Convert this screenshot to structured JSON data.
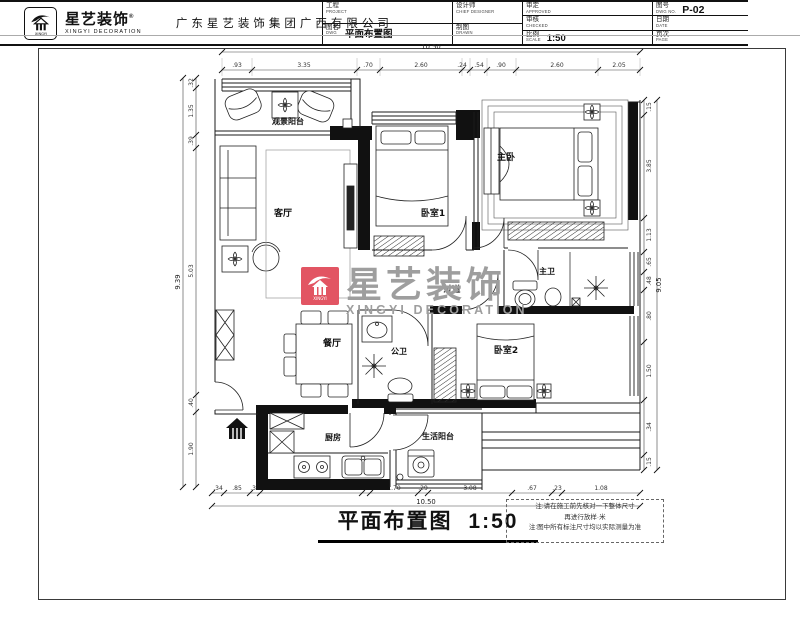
{
  "plan": {
    "rooms": {
      "balcony_view": "观景阳台",
      "living": "客厅",
      "bed1": "卧室1",
      "master": "主卧",
      "master_bath": "主卫",
      "dining": "餐厅",
      "guest_bath": "公卫",
      "corridor": "过道",
      "bed2": "卧室2",
      "kitchen": "厨房",
      "utility_balcony": "生活阳台"
    },
    "title": {
      "text": "平面布置图",
      "scale": "1:50"
    },
    "watermark": {
      "cn": "星艺装饰",
      "en": "XINGYI DECORATION"
    },
    "notes": {
      "line1": "注:请在施工前先核对一下整体尺寸",
      "line2": "再进行放样·米",
      "line3": "注:图中所有标注尺寸均以实际测量为准"
    }
  },
  "dims": {
    "top": {
      "total": "10.50",
      "segments": [
        ".93",
        "3.35",
        ".70",
        "2.60",
        ".24",
        ".54",
        ".90",
        "2.60",
        "2.05"
      ]
    },
    "bottom": {
      "total": "10.50",
      "segments": [
        ".34",
        ".85",
        ".34",
        "3.65",
        ".24",
        "1.70",
        ".29",
        "3.08",
        ".67",
        ".23",
        "1.08"
      ]
    },
    "left": {
      "total": "9.39",
      "segments": [
        ".32",
        "1.35",
        ".39",
        "5.03",
        ".40",
        "1.90"
      ]
    },
    "right": {
      "total": "9.05",
      "segments": [
        ".15",
        "3.85",
        "1.13",
        ".65",
        ".48",
        ".80",
        "1.50",
        ".34",
        ".15"
      ]
    }
  },
  "titleblock": {
    "logo": {
      "cn": "星艺装饰",
      "reg": "®",
      "en": "XINGYI DECORATION",
      "mark": "XINGYI"
    },
    "company": "广东星艺装饰集团广西有限公司",
    "fields": {
      "project": {
        "cn": "工程",
        "en": "PROJECT",
        "value": ""
      },
      "dwg": {
        "cn": "图名",
        "en": "DWG",
        "value": "平面布置图"
      },
      "designer": {
        "cn": "设计师",
        "en": "CHIEF DESIGNER",
        "value": ""
      },
      "drawn": {
        "cn": "制图",
        "en": "DRAWN",
        "value": ""
      },
      "approved": {
        "cn": "审定",
        "en": "APPROVED",
        "value": ""
      },
      "checked": {
        "cn": "审核",
        "en": "CHECKED",
        "value": ""
      },
      "scale": {
        "cn": "比例",
        "en": "SCALE",
        "value": "1:50"
      },
      "dwg_no": {
        "cn": "图号",
        "en": "DWG NO.",
        "value": "P-02"
      },
      "date": {
        "cn": "日期",
        "en": "DATE",
        "value": ""
      },
      "page": {
        "cn": "页次",
        "en": "PAGE",
        "value": ""
      }
    }
  },
  "colors": {
    "accent": "#e25563",
    "watermark_text": "#9e9e9e",
    "line": "#1b1b1b"
  }
}
